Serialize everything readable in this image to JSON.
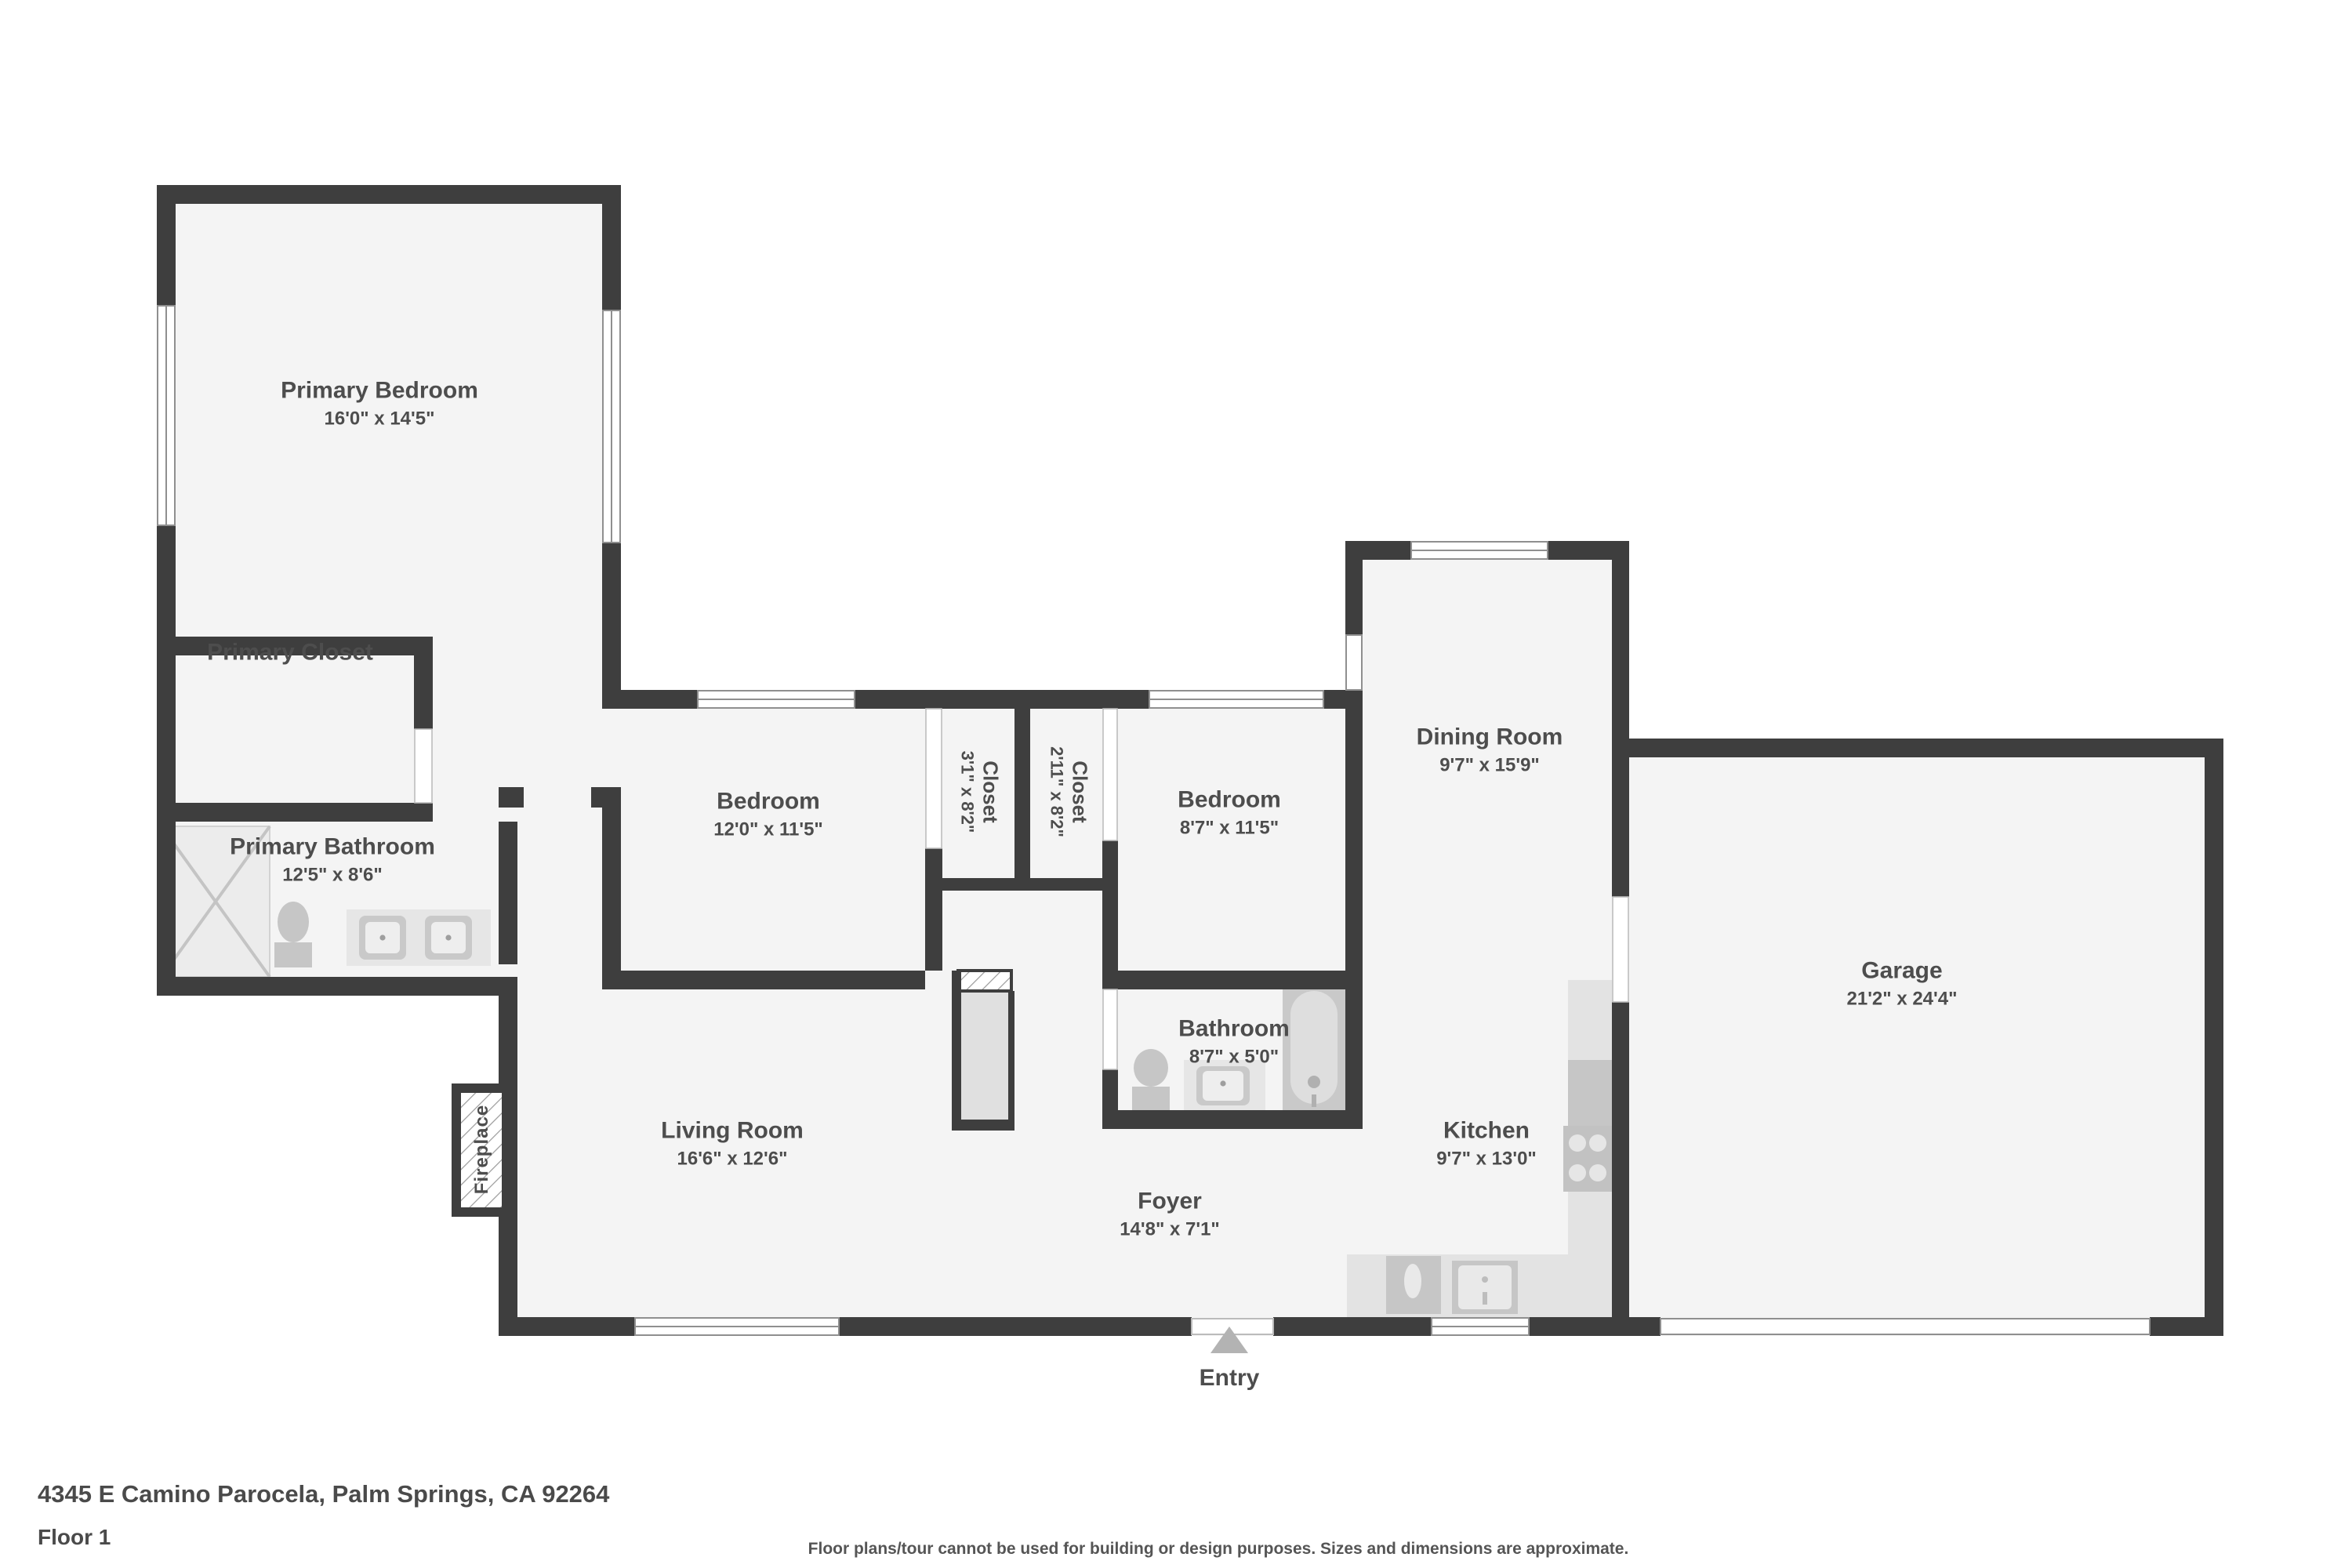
{
  "rooms": {
    "primary_bedroom": {
      "name": "Primary Bedroom",
      "dims": "16'0\" x 14'5\""
    },
    "primary_closet": {
      "name": "Primary Closet",
      "dims": ""
    },
    "primary_bathroom": {
      "name": "Primary Bathroom",
      "dims": "12'5\" x 8'6\""
    },
    "bedroom_left": {
      "name": "Bedroom",
      "dims": "12'0\" x 11'5\""
    },
    "closet_left": {
      "name": "Closet",
      "dims": "3'1\" x 8'2\""
    },
    "closet_right": {
      "name": "Closet",
      "dims": "2'11\" x 8'2\""
    },
    "bedroom_right": {
      "name": "Bedroom",
      "dims": "8'7\" x 11'5\""
    },
    "dining_room": {
      "name": "Dining Room",
      "dims": "9'7\" x 15'9\""
    },
    "garage": {
      "name": "Garage",
      "dims": "21'2\" x 24'4\""
    },
    "bathroom": {
      "name": "Bathroom",
      "dims": "8'7\" x 5'0\""
    },
    "kitchen": {
      "name": "Kitchen",
      "dims": "9'7\" x 13'0\""
    },
    "living_room": {
      "name": "Living Room",
      "dims": "16'6\" x 12'6\""
    },
    "foyer": {
      "name": "Foyer",
      "dims": "14'8\" x 7'1\""
    }
  },
  "annotations": {
    "entry": "Entry",
    "fireplace": "Fireplace"
  },
  "footer": {
    "address": "4345 E Camino Parocela, Palm Springs, CA 92264",
    "floor_label": "Floor 1",
    "disclaimer": "Floor plans/tour cannot be used for building or design purposes. Sizes and dimensions are approximate."
  },
  "colors": {
    "wall": "#3e3e3e",
    "floor": "#f4f4f4",
    "fixture_light": "#e3e3e3",
    "fixture_mid": "#c6c6c6",
    "text": "#4d4d4d",
    "entry_arrow": "#b3b3b3",
    "window_line": "#8f8f8f"
  }
}
